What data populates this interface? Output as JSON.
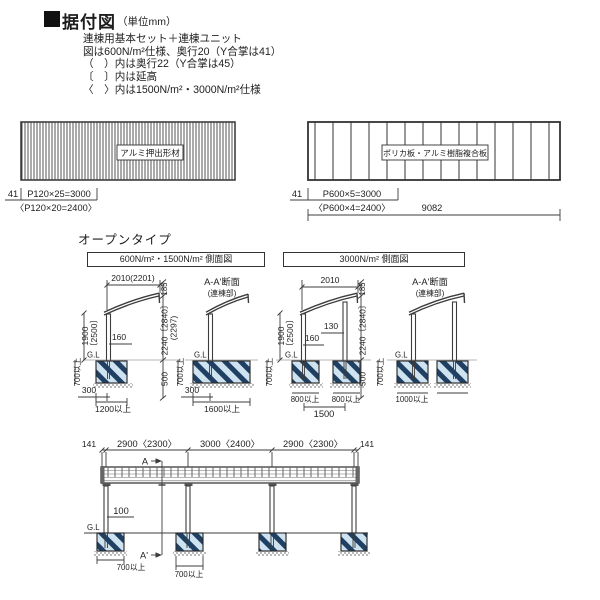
{
  "header": {
    "title": "据付図",
    "unit": "（単位mm）",
    "notes": [
      "連棟用基本セット＋連棟ユニット",
      "図は600N/m²仕様、奥行20（Y合掌は41）",
      "（　）内は奥行22（Y合掌は45）",
      "〔　〕内は延高",
      "〈　〉内は1500N/m²・3000N/m²仕様"
    ]
  },
  "materials": {
    "aluminum": {
      "label": "アルミ押出形材",
      "edge": "41",
      "pitch": "P120×25=3000",
      "pitch_alt": "〈P120×20=2400〉"
    },
    "panel": {
      "label": "ポリカ板・アルミ樹脂複合板",
      "edge": "41",
      "pitch": "P600×5=3000",
      "pitch_alt": "〈P600×4=2400〉",
      "total": "9082"
    }
  },
  "open_type": {
    "label": "オープンタイプ",
    "d1": {
      "title": "600N/m²・1500N/m² 側面図",
      "width": "2010(2201)",
      "front_h": "185",
      "total_h": "2240〔2840〕",
      "total_h_alt": "(2297)",
      "below": "500",
      "post_h": "1900",
      "post_h_alt": "〔2500〕",
      "embed": "700以上",
      "gl": "G.L",
      "offset": "160",
      "edge": "300",
      "footing": "1200以上",
      "section": {
        "title": "A-A'断面",
        "subtitle": "(連棟部)",
        "gl": "G.L",
        "embed": "700以上",
        "edge": "300",
        "footing": "1600以上"
      }
    },
    "d2": {
      "title": "3000N/m² 側面図",
      "width": "2010",
      "front_h": "185",
      "total_h": "2240〔2840〕",
      "below": "500",
      "post_h": "1900",
      "post_h_alt": "〔2500〕",
      "embed": "700以上",
      "gl": "G.L",
      "offset_front": "130",
      "offset": "160",
      "footing1": "800以上",
      "footing2": "800以上",
      "span": "1500",
      "section": {
        "title": "A-A'断面",
        "subtitle": "(連棟部)",
        "gl": "G.L",
        "embed": "700以上",
        "footing1": "1000以上",
        "footing2": "1000以上"
      }
    }
  },
  "elevation": {
    "edge_left": "141",
    "span1": "2900〈2300〉",
    "span2": "3000〈2400〉",
    "span3": "2900〈2300〉",
    "edge_right": "141",
    "section_start": "A",
    "section_end": "A'",
    "post_dim": "100",
    "gl": "G.L",
    "footing1": "700以上",
    "footing2": "700以上"
  },
  "colors": {
    "line": "#3c3c3c",
    "footing_fill": "#cfe2ef",
    "footing_stripe": "#1f4063",
    "text": "#1e1e1e"
  }
}
